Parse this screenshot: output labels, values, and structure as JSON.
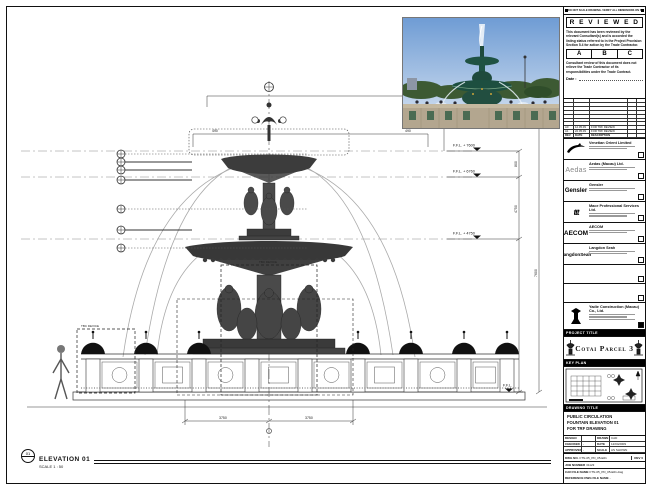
{
  "sheet_note": "DO NOT SCALE DRAWING. VERIFY ALL DIMENSIONS ON SITE.",
  "reviewed": {
    "title": "R E V I E W E D",
    "para1": "This document has been reviewed by the relevant Consultant(s) and is accorded the listing status referred to in the Project Provision Section 5.4 for action by the Trade Contractor.",
    "grades": [
      "A",
      "B",
      "C"
    ],
    "para2": "Consultant review of this document does not relieve the Trade Contractor of its responsibilities under the Trade Contract.",
    "date_label": "Date :"
  },
  "revision_table": {
    "entries": [
      {
        "rev": "A0",
        "date": "12.05.09",
        "desc": "FOR TRF REVIEW"
      },
      {
        "rev": "A1",
        "date": "22.05.09",
        "desc": "FOR TRF REVIEW"
      }
    ],
    "header": {
      "rev": "REV",
      "date": "DATE",
      "desc": "DESCRIPTION"
    }
  },
  "companies": [
    {
      "name": "Venetian Orient Limited"
    },
    {
      "name": "Aedas (Macau) Ltd.",
      "logo_text": "Aedas"
    },
    {
      "name": "Gensler",
      "logo_text": "Gensler"
    },
    {
      "name": "Mace Professional Services Ltd.",
      "logo_text": "ttt"
    },
    {
      "name": "AECOM",
      "logo_text": "AECOM"
    },
    {
      "name": "Langdon Seah",
      "logo_text": "LangdonSeah"
    }
  ],
  "contractor": {
    "name": "Yadie Construction (Macau) Co., Ltd."
  },
  "project": {
    "title_label": "PROJECT TITLE",
    "title": "Cotai Parcel 3"
  },
  "key_plan": {
    "label": "KEY PLAN"
  },
  "drawing_title": {
    "label": "DRAWING TITLE",
    "lines": [
      "PUBLIC CIRCULATION",
      "FOUNTAIN ELEVATION 01",
      "FOR TRF DRAWING"
    ]
  },
  "credits": {
    "rows": [
      {
        "l1": "DESIGN",
        "v1": "",
        "l2": "DRAWN",
        "v2": "CAD"
      },
      {
        "l1": "CHECKED",
        "v1": "-",
        "l2": "DATE",
        "v2": "12/04/2009"
      },
      {
        "l1": "APPROVED",
        "v1": "-",
        "l2": "SCALE",
        "v2": "AS SHOWN"
      }
    ]
  },
  "doc_rows": {
    "dwg_label": "DWG NO.",
    "dwg_no": "FTN-05_PD_05-E01",
    "rev": "REV 0",
    "job_label": "JOB NUMBER",
    "job_no": "31123",
    "cad_label": "CAD FILE NAME",
    "cad_value": "FTN-05_PD_05-E01.dwg",
    "ref_label": "REFERENCE DWG FILE NAME",
    "ref_value": "-"
  },
  "elevation_label": {
    "bubble": "01",
    "title": "ELEVATION 01",
    "scale": "SCALE 1 : 50"
  },
  "levels": [
    {
      "text": "F.F.L. + 7600"
    },
    {
      "text": "F.F.L. + 6760"
    },
    {
      "text": "F.F.L. + 4750"
    },
    {
      "text": "F.F.L."
    }
  ],
  "dims": {
    "d490a": "490",
    "d490b": "490",
    "d800": "800",
    "d4750": "4750",
    "d7600": "7600",
    "d3750a": "3750",
    "d3750b": "3750"
  },
  "notes": {
    "tbc": "TBC DEVICE"
  }
}
